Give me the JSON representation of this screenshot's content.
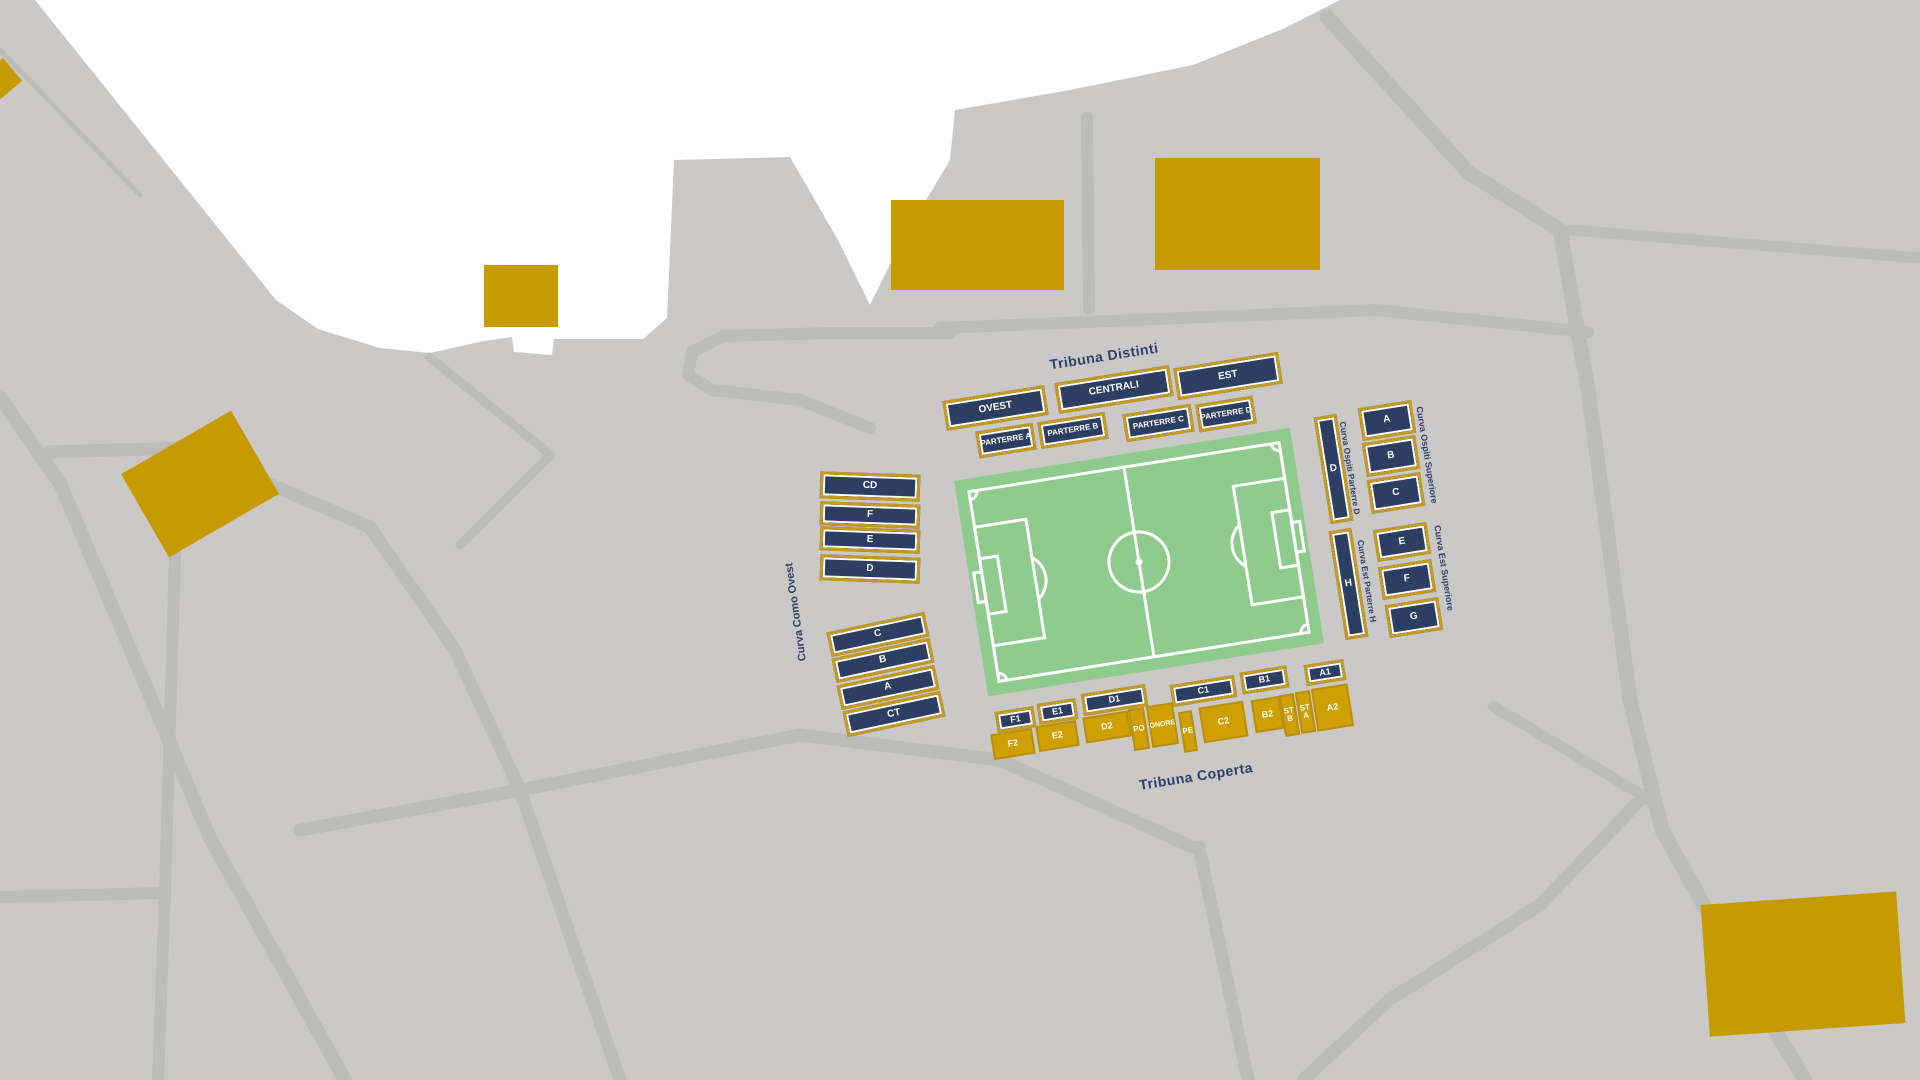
{
  "map": {
    "title": "Stadium seating map",
    "colors": {
      "land_gray": "#cac9c7",
      "road_gray": "#bcbcbb",
      "lake_white": "#ffffff",
      "building_gold": "#c69b01",
      "section_navy": "#2d3e63",
      "section_border_gold": "#c49a22",
      "section_gold_fill": "#cfa004",
      "pitch_green": "#8ecb8d",
      "pitch_line_white": "#ffffff",
      "label_navy": "#2d4168"
    },
    "stand_labels": {
      "tribuna_distinti": "Tribuna Distinti",
      "tribuna_coperta": "Tribuna Coperta",
      "curva_como_ovest": "Curva Como Ovest",
      "curva_ospiti_parterre_d": "Curva Ospiti Parterre D",
      "curva_ospiti_superiore": "Curva Ospiti Superiore",
      "curva_est_parterre_h": "Curva Est Parterre H",
      "curva_est_superiore": "Curva Est Superiore"
    },
    "sections": [
      {
        "id": "ovest",
        "label": "OVEST"
      },
      {
        "id": "centrali",
        "label": "CENTRALI"
      },
      {
        "id": "est",
        "label": "EST"
      },
      {
        "id": "parterre-a",
        "label": "PARTERRE A"
      },
      {
        "id": "parterre-b",
        "label": "PARTERRE B"
      },
      {
        "id": "parterre-c",
        "label": "PARTERRE C"
      },
      {
        "id": "parterre-d",
        "label": "PARTERRE D"
      },
      {
        "id": "curva-ospiti-d",
        "label": "D"
      },
      {
        "id": "curva-ospiti-a",
        "label": "A"
      },
      {
        "id": "curva-ospiti-b",
        "label": "B"
      },
      {
        "id": "curva-ospiti-c",
        "label": "C"
      },
      {
        "id": "curva-est-h",
        "label": "H"
      },
      {
        "id": "curva-est-e",
        "label": "E"
      },
      {
        "id": "curva-est-f",
        "label": "F"
      },
      {
        "id": "curva-est-g",
        "label": "G"
      },
      {
        "id": "west-cd",
        "label": "CD"
      },
      {
        "id": "west-f",
        "label": "F"
      },
      {
        "id": "west-e",
        "label": "E"
      },
      {
        "id": "west-d",
        "label": "D"
      },
      {
        "id": "west-c",
        "label": "C"
      },
      {
        "id": "west-b",
        "label": "B"
      },
      {
        "id": "west-a",
        "label": "A"
      },
      {
        "id": "west-ct",
        "label": "CT"
      },
      {
        "id": "f1",
        "label": "F1"
      },
      {
        "id": "e1",
        "label": "E1"
      },
      {
        "id": "d1",
        "label": "D1"
      },
      {
        "id": "c1",
        "label": "C1"
      },
      {
        "id": "b1",
        "label": "B1"
      },
      {
        "id": "a1",
        "label": "A1"
      },
      {
        "id": "f2",
        "label": "F2"
      },
      {
        "id": "e2",
        "label": "E2"
      },
      {
        "id": "d2",
        "label": "D2"
      },
      {
        "id": "po",
        "label": "PO"
      },
      {
        "id": "onore",
        "label": "ONORE"
      },
      {
        "id": "pe",
        "label": "PE"
      },
      {
        "id": "c2",
        "label": "C2"
      },
      {
        "id": "b2",
        "label": "B2"
      },
      {
        "id": "st-b",
        "label": "ST B"
      },
      {
        "id": "st-a",
        "label": "ST A"
      },
      {
        "id": "a2",
        "label": "A2"
      }
    ]
  }
}
